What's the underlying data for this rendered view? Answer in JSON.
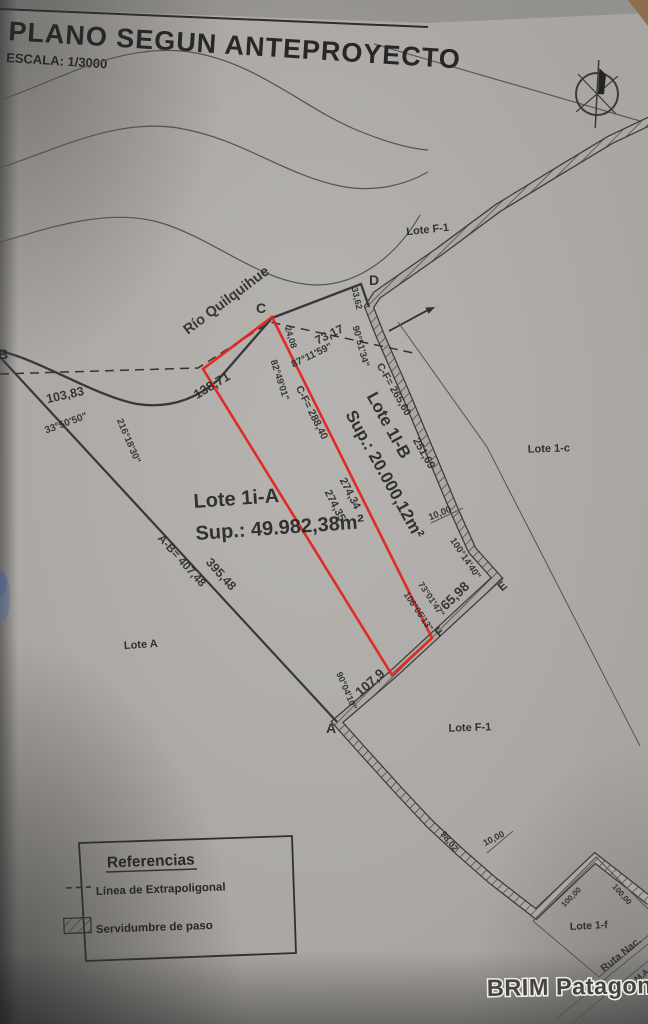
{
  "page": {
    "title": "PLANO SEGUN ANTEPROYECTO",
    "scale": "ESCALA: 1/3000"
  },
  "watermark": {
    "text": "BRIM Patagonia"
  },
  "river": {
    "name": "Río Quilquihue"
  },
  "icons": {
    "compass": "north-compass-icon",
    "river_arrow": "flow-direction-arrow-icon"
  },
  "legend": {
    "title": "Referencias",
    "items": [
      {
        "symbol": "dashed-line",
        "label": "Línea de Extrapoligonal"
      },
      {
        "symbol": "hatch-band",
        "label": "Servidumbre de paso"
      }
    ]
  },
  "lots": [
    {
      "name": "Lote 1i-A",
      "area": "Sup.: 49.982,38m²"
    },
    {
      "name": "Lote 1I-B",
      "area": "Sup.: 20.000,12m²"
    },
    {
      "name": "Lote F-1"
    },
    {
      "name": "Lote 1-c"
    },
    {
      "name": "Lote A"
    },
    {
      "name": "Lote F-1"
    },
    {
      "name": "Lote 1-f"
    }
  ],
  "points": {
    "a": "A",
    "b": "B",
    "c": "C",
    "d": "D",
    "e": "E",
    "f": "F"
  },
  "route": {
    "name": "Ruta Nac.",
    "dest": "A S.M.A."
  },
  "measurements": [
    {
      "text": "138,71"
    },
    {
      "text": "73,17"
    },
    {
      "text": "87°11'59\""
    },
    {
      "text": "24,08"
    },
    {
      "text": "82°49'01\""
    },
    {
      "text": "103,83"
    },
    {
      "text": "33°50'50\""
    },
    {
      "text": "216°18'30\""
    },
    {
      "text": "C-F= 288,40"
    },
    {
      "text": "274,35"
    },
    {
      "text": "274,34"
    },
    {
      "text": "C-F= 265,60"
    },
    {
      "text": "251,69"
    },
    {
      "text": "10,00"
    },
    {
      "text": "100°14'40\""
    },
    {
      "text": "65,98"
    },
    {
      "text": "73°01'47\""
    },
    {
      "text": "106°06'13\""
    },
    {
      "text": "107,9"
    },
    {
      "text": "90°04'10\""
    },
    {
      "text": "A-B= 407,48"
    },
    {
      "text": "395,48"
    },
    {
      "text": "33,62"
    },
    {
      "text": "90°51'34\""
    },
    {
      "text": "98,02"
    },
    {
      "text": "10,00"
    },
    {
      "text": "100,00"
    },
    {
      "text": "100,00"
    }
  ],
  "colors": {
    "parcel_outline": "#e2251d",
    "paper": "#a9a6a2",
    "ink": "#2a2a2a"
  }
}
